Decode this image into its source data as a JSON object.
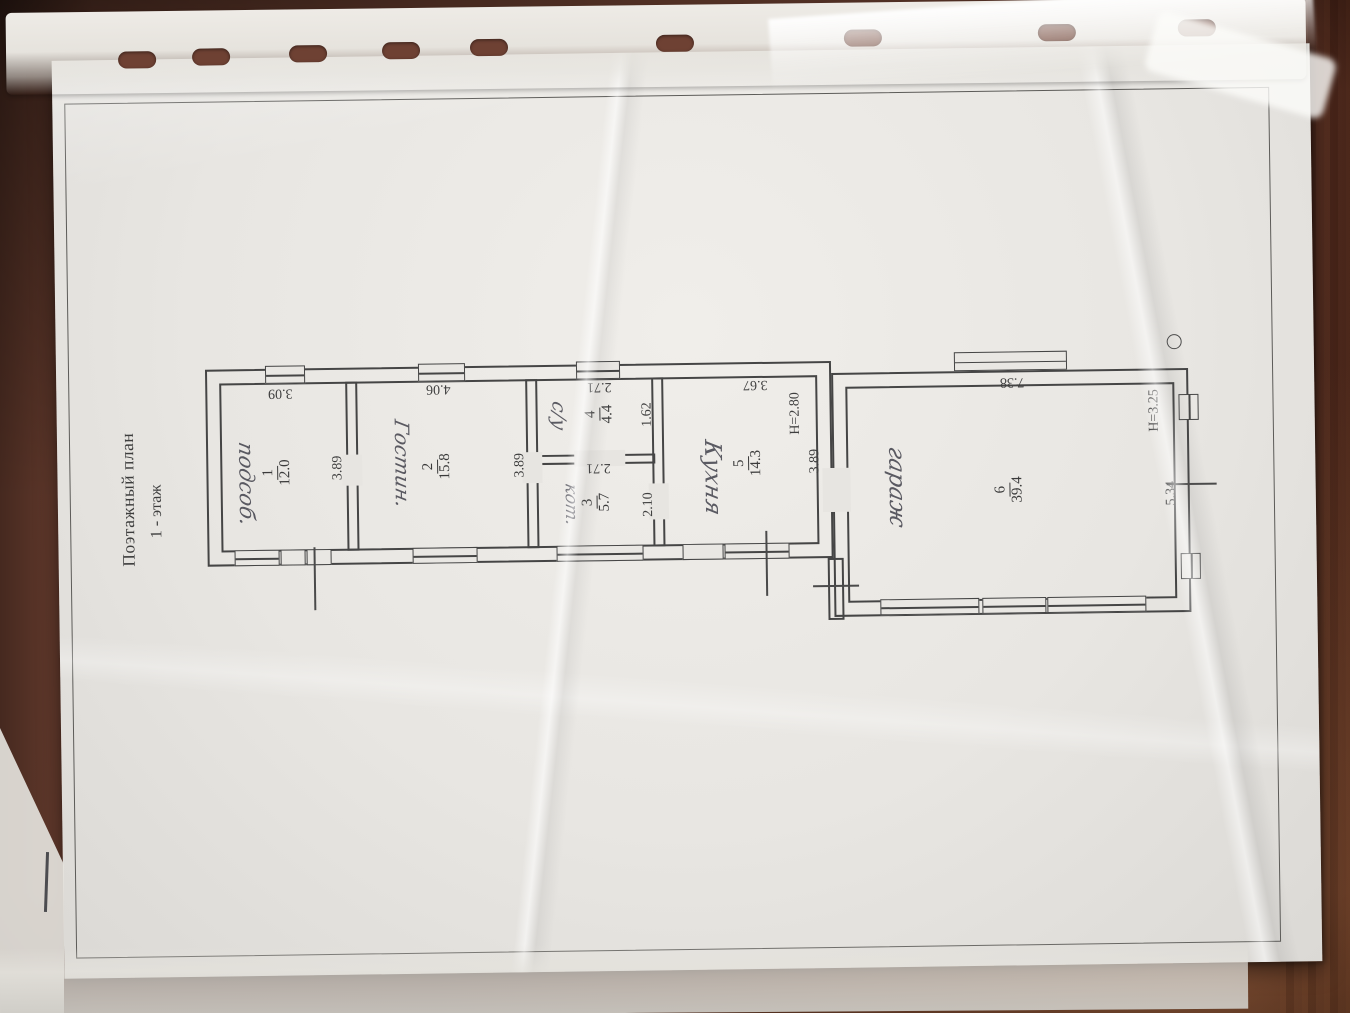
{
  "document": {
    "title": "Поэтажный план",
    "subtitle": "1 - этаж"
  },
  "floor_plan": {
    "rooms": [
      {
        "number": "1",
        "area": "12.0",
        "handwritten_name": "подсоб."
      },
      {
        "number": "2",
        "area": "15.8",
        "handwritten_name": "Гостин."
      },
      {
        "number": "3",
        "area": "5.7",
        "handwritten_name": "кот."
      },
      {
        "number": "4",
        "area": "4.4",
        "handwritten_name": "с/у"
      },
      {
        "number": "5",
        "area": "14.3",
        "handwritten_name": "Кухня"
      },
      {
        "number": "6",
        "area": "39.4",
        "handwritten_name": "гараж"
      }
    ],
    "room_labels": [
      {
        "number": "1",
        "area": "12.0",
        "x": 278,
        "y": 470
      },
      {
        "number": "2",
        "area": "15.8",
        "x": 438,
        "y": 466
      },
      {
        "number": "3",
        "area": "5.7",
        "x": 597,
        "y": 504
      },
      {
        "number": "4",
        "area": "4.4",
        "x": 601,
        "y": 416
      },
      {
        "number": "5",
        "area": "14.3",
        "x": 749,
        "y": 467
      },
      {
        "number": "6",
        "area": "39.4",
        "x": 1010,
        "y": 497
      }
    ],
    "dimension_labels": [
      {
        "text": "3.09",
        "x": 282,
        "y": 390,
        "rot": 180
      },
      {
        "text": "3.89",
        "x": 339,
        "y": 466,
        "rot": -90
      },
      {
        "text": "4.06",
        "x": 440,
        "y": 388,
        "rot": 180
      },
      {
        "text": "3.89",
        "x": 521,
        "y": 466,
        "rot": -90
      },
      {
        "text": "2.71",
        "x": 601,
        "y": 388,
        "rot": 180
      },
      {
        "text": "1.62",
        "x": 649,
        "y": 417,
        "rot": -90
      },
      {
        "text": "2.71",
        "x": 599,
        "y": 469,
        "rot": 180
      },
      {
        "text": "2.10",
        "x": 649,
        "y": 507,
        "rot": -90
      },
      {
        "text": "3.67",
        "x": 757,
        "y": 388,
        "rot": 180
      },
      {
        "text": "H=2.80",
        "x": 797,
        "y": 418,
        "rot": -90
      },
      {
        "text": "3.89",
        "x": 816,
        "y": 466,
        "rot": -90
      },
      {
        "text": "7.38",
        "x": 1014,
        "y": 389,
        "rot": 180
      },
      {
        "text": "H=3.25",
        "x": 1156,
        "y": 420,
        "rot": -90
      },
      {
        "text": "5.34",
        "x": 1172,
        "y": 503,
        "rot": -90
      }
    ],
    "handwritten_labels": [
      {
        "text": "подсоб.",
        "x": 247,
        "y": 481,
        "size": 21
      },
      {
        "text": "Гостин.",
        "x": 403,
        "y": 463,
        "size": 20
      },
      {
        "text": "кот.",
        "x": 571,
        "y": 506,
        "size": 17
      },
      {
        "text": "с/у",
        "x": 560,
        "y": 417,
        "size": 19
      },
      {
        "text": "Кухня",
        "x": 713,
        "y": 481,
        "size": 23
      },
      {
        "text": "гараж",
        "x": 897,
        "y": 493,
        "size": 23
      }
    ]
  }
}
